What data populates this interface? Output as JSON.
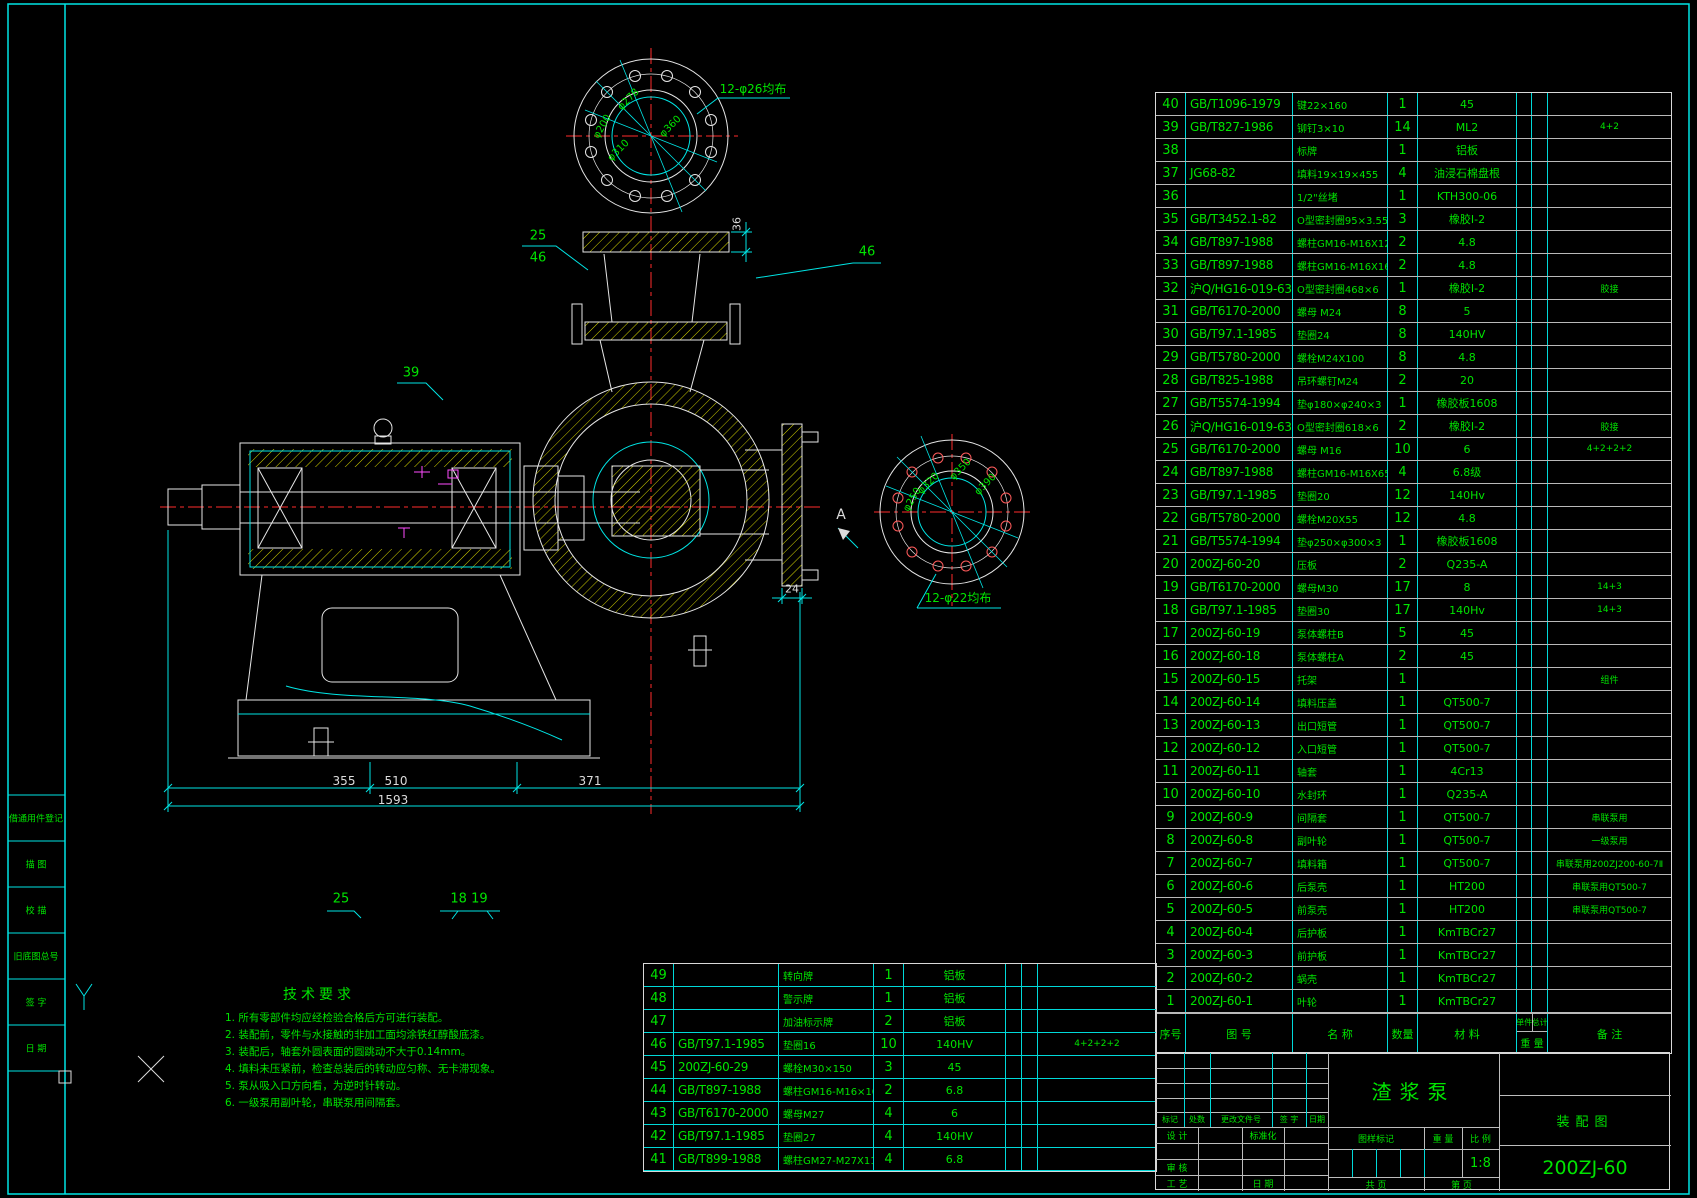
{
  "drawing": {
    "part_name": "渣浆泵",
    "sheet_type": "装配图",
    "drawing_no": "200ZJ-60",
    "scale_value": "1:8"
  },
  "sidebar": {
    "items": [
      "借通用件登记",
      "描  图",
      "校  描",
      "旧底图总号",
      "签  字",
      "日  期"
    ]
  },
  "tech_req": {
    "title": "技术要求",
    "items": [
      "1. 所有零部件均应经检验合格后方可进行装配。",
      "2. 装配前，零件与水接触的非加工面均涂铁红醇酸底漆。",
      "3. 装配后，轴套外圆表面的圆跳动不大于0.14mm。",
      "4. 填料未压紧前，检查总装后的转动应匀称、无卡滞现象。",
      "5. 泵从吸入口方向看，为逆时针转动。",
      "6. 一级泵用副叶轮，串联泵用间隔套。"
    ]
  },
  "labels": {
    "top_note": "12-φ26均布",
    "d278": "φ278",
    "d200": "φ200",
    "d310": "φ310",
    "d360": "φ360",
    "right_note": "12-φ22均布",
    "d320": "φ320",
    "d250": "φ250",
    "d350": "φ350",
    "d390": "φ390",
    "b25": "25",
    "b46": "46",
    "b39": "39",
    "b46b": "46",
    "dim36": "36",
    "secA": "A",
    "dim24": "24",
    "dim355": "355",
    "dim510": "510",
    "dim371": "371",
    "dim1593": "1593",
    "b25b": "25",
    "b1819": "18 19"
  },
  "bom_header": {
    "no": "序号",
    "code": "图    号",
    "name": "名    称",
    "qty": "数量",
    "mat": "材    料",
    "unit": "单件",
    "total": "总计",
    "weight": "重  量",
    "remark": "备    注"
  },
  "bom_right": {
    "rows": [
      {
        "no": "40",
        "code": "GB/T1096-1979",
        "name": "键22×160",
        "qty": "1",
        "mat": "45",
        "rk": ""
      },
      {
        "no": "39",
        "code": "GB/T827-1986",
        "name": "铆钉3×10",
        "qty": "14",
        "mat": "ML2",
        "rk": "4+2"
      },
      {
        "no": "38",
        "code": "",
        "name": "标牌",
        "qty": "1",
        "mat": "铝板",
        "rk": ""
      },
      {
        "no": "37",
        "code": "JG68-82",
        "name": "填料19×19×455",
        "qty": "4",
        "mat": "油浸石棉盘根",
        "rk": ""
      },
      {
        "no": "36",
        "code": "",
        "name": "1/2\"丝堵",
        "qty": "1",
        "mat": "KTH300-06",
        "rk": ""
      },
      {
        "no": "35",
        "code": "GB/T3452.1-82",
        "name": "O型密封圈95×3.55",
        "qty": "3",
        "mat": "橡胶I-2",
        "rk": ""
      },
      {
        "no": "34",
        "code": "GB/T897-1988",
        "name": "螺柱GM16-M16X120",
        "qty": "2",
        "mat": "4.8",
        "rk": ""
      },
      {
        "no": "33",
        "code": "GB/T897-1988",
        "name": "螺柱GM16-M16X160",
        "qty": "2",
        "mat": "4.8",
        "rk": ""
      },
      {
        "no": "32",
        "code": "沪Q/HG16-019-63",
        "name": "O型密封圈468×6",
        "qty": "1",
        "mat": "橡胶I-2",
        "rk": "胶接"
      },
      {
        "no": "31",
        "code": "GB/T6170-2000",
        "name": "螺母 M24",
        "qty": "8",
        "mat": "5",
        "rk": ""
      },
      {
        "no": "30",
        "code": "GB/T97.1-1985",
        "name": "垫圈24",
        "qty": "8",
        "mat": "140HV",
        "rk": ""
      },
      {
        "no": "29",
        "code": "GB/T5780-2000",
        "name": "螺栓M24X100",
        "qty": "8",
        "mat": "4.8",
        "rk": ""
      },
      {
        "no": "28",
        "code": "GB/T825-1988",
        "name": "吊环螺钉M24",
        "qty": "2",
        "mat": "20",
        "rk": ""
      },
      {
        "no": "27",
        "code": "GB/T5574-1994",
        "name": "垫φ180×φ240×3",
        "qty": "1",
        "mat": "橡胶板1608",
        "rk": ""
      },
      {
        "no": "26",
        "code": "沪Q/HG16-019-63",
        "name": "O型密封圈618×6",
        "qty": "2",
        "mat": "橡胶I-2",
        "rk": "胶接"
      },
      {
        "no": "25",
        "code": "GB/T6170-2000",
        "name": "螺母 M16",
        "qty": "10",
        "mat": "6",
        "rk": "4+2+2+2"
      },
      {
        "no": "24",
        "code": "GB/T897-1988",
        "name": "螺柱GM16-M16X65",
        "qty": "4",
        "mat": "6.8级",
        "rk": ""
      },
      {
        "no": "23",
        "code": "GB/T97.1-1985",
        "name": "垫圈20",
        "qty": "12",
        "mat": "140Hv",
        "rk": ""
      },
      {
        "no": "22",
        "code": "GB/T5780-2000",
        "name": "螺栓M20X55",
        "qty": "12",
        "mat": "4.8",
        "rk": ""
      },
      {
        "no": "21",
        "code": "GB/T5574-1994",
        "name": "垫φ250×φ300×3",
        "qty": "1",
        "mat": "橡胶板1608",
        "rk": ""
      },
      {
        "no": "20",
        "code": "200ZJ-60-20",
        "name": "压板",
        "qty": "2",
        "mat": "Q235-A",
        "rk": ""
      },
      {
        "no": "19",
        "code": "GB/T6170-2000",
        "name": "螺母M30",
        "qty": "17",
        "mat": "8",
        "rk": "14+3"
      },
      {
        "no": "18",
        "code": "GB/T97.1-1985",
        "name": "垫圈30",
        "qty": "17",
        "mat": "140Hv",
        "rk": "14+3"
      },
      {
        "no": "17",
        "code": "200ZJ-60-19",
        "name": "泵体螺柱B",
        "qty": "5",
        "mat": "45",
        "rk": ""
      },
      {
        "no": "16",
        "code": "200ZJ-60-18",
        "name": "泵体螺柱A",
        "qty": "2",
        "mat": "45",
        "rk": ""
      },
      {
        "no": "15",
        "code": "200ZJ-60-15",
        "name": "托架",
        "qty": "1",
        "mat": "",
        "rk": "组件"
      },
      {
        "no": "14",
        "code": "200ZJ-60-14",
        "name": "填料压盖",
        "qty": "1",
        "mat": "QT500-7",
        "rk": ""
      },
      {
        "no": "13",
        "code": "200ZJ-60-13",
        "name": "出口短管",
        "qty": "1",
        "mat": "QT500-7",
        "rk": ""
      },
      {
        "no": "12",
        "code": "200ZJ-60-12",
        "name": "入口短管",
        "qty": "1",
        "mat": "QT500-7",
        "rk": ""
      },
      {
        "no": "11",
        "code": "200ZJ-60-11",
        "name": "轴套",
        "qty": "1",
        "mat": "4Cr13",
        "rk": ""
      },
      {
        "no": "10",
        "code": "200ZJ-60-10",
        "name": "水封环",
        "qty": "1",
        "mat": "Q235-A",
        "rk": ""
      },
      {
        "no": "9",
        "code": "200ZJ-60-9",
        "name": "间隔套",
        "qty": "1",
        "mat": "QT500-7",
        "rk": "串联泵用"
      },
      {
        "no": "8",
        "code": "200ZJ-60-8",
        "name": "副叶轮",
        "qty": "1",
        "mat": "QT500-7",
        "rk": "一级泵用"
      },
      {
        "no": "7",
        "code": "200ZJ-60-7",
        "name": "填料箱",
        "qty": "1",
        "mat": "QT500-7",
        "rk": "串联泵用200ZJ200-60-7Ⅱ"
      },
      {
        "no": "6",
        "code": "200ZJ-60-6",
        "name": "后泵壳",
        "qty": "1",
        "mat": "HT200",
        "rk": "串联泵用QT500-7"
      },
      {
        "no": "5",
        "code": "200ZJ-60-5",
        "name": "前泵壳",
        "qty": "1",
        "mat": "HT200",
        "rk": "串联泵用QT500-7"
      },
      {
        "no": "4",
        "code": "200ZJ-60-4",
        "name": "后护板",
        "qty": "1",
        "mat": "KmTBCr27",
        "rk": ""
      },
      {
        "no": "3",
        "code": "200ZJ-60-3",
        "name": "前护板",
        "qty": "1",
        "mat": "KmTBCr27",
        "rk": ""
      },
      {
        "no": "2",
        "code": "200ZJ-60-2",
        "name": "蜗壳",
        "qty": "1",
        "mat": "KmTBCr27",
        "rk": ""
      },
      {
        "no": "1",
        "code": "200ZJ-60-1",
        "name": "叶轮",
        "qty": "1",
        "mat": "KmTBCr27",
        "rk": ""
      }
    ]
  },
  "bom_bottom": {
    "rows": [
      {
        "no": "49",
        "code": "",
        "name": "转向牌",
        "qty": "1",
        "mat": "铝板",
        "rk": ""
      },
      {
        "no": "48",
        "code": "",
        "name": "警示牌",
        "qty": "1",
        "mat": "铝板",
        "rk": ""
      },
      {
        "no": "47",
        "code": "",
        "name": "加油标示牌",
        "qty": "2",
        "mat": "铝板",
        "rk": ""
      },
      {
        "no": "46",
        "code": "GB/T97.1-1985",
        "name": "垫圈16",
        "qty": "10",
        "mat": "140HV",
        "rk": "4+2+2+2"
      },
      {
        "no": "45",
        "code": "200ZJ-60-29",
        "name": "螺栓M30×150",
        "qty": "3",
        "mat": "45",
        "rk": ""
      },
      {
        "no": "44",
        "code": "GB/T897-1988",
        "name": "螺柱GM16-M16×100",
        "qty": "2",
        "mat": "6.8",
        "rk": ""
      },
      {
        "no": "43",
        "code": "GB/T6170-2000",
        "name": "螺母M27",
        "qty": "4",
        "mat": "6",
        "rk": ""
      },
      {
        "no": "42",
        "code": "GB/T97.1-1985",
        "name": "垫圈27",
        "qty": "4",
        "mat": "140HV",
        "rk": ""
      },
      {
        "no": "41",
        "code": "GB/T899-1988",
        "name": "螺柱GM27-M27X110",
        "qty": "4",
        "mat": "6.8",
        "rk": ""
      }
    ]
  },
  "title_block": {
    "mark": "标记",
    "count": "处数",
    "change_file": "更改文件号",
    "sign": "签 字",
    "date": "日期",
    "design": "设 计",
    "standard": "标准化",
    "audit": "审 核",
    "craft": "工 艺",
    "date2": "日 期",
    "mark_header": "图样标记",
    "weight": "重 量",
    "scale": "比 例",
    "total_pages": "共    页",
    "page_no": "第    页"
  }
}
